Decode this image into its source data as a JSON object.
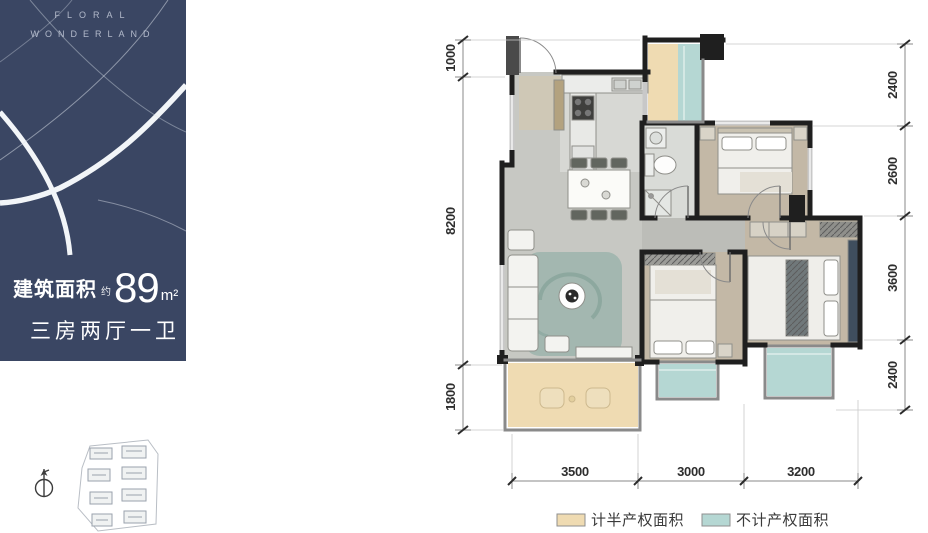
{
  "brand": {
    "line1": "FLORAL",
    "line2": "WONDERLAND"
  },
  "info": {
    "area_label": "建筑面积",
    "approx": "约",
    "area_value": "89",
    "area_unit": "m²",
    "layout": "三房两厅一卫"
  },
  "dims": {
    "left": [
      "1000",
      "8200",
      "1800"
    ],
    "right": [
      "2400",
      "2600",
      "3600",
      "2400"
    ],
    "bottom": [
      "3500",
      "3000",
      "3200"
    ]
  },
  "legend": [
    {
      "label": "计半产权面积",
      "color": "#efdbb2"
    },
    {
      "label": "不计产权面积",
      "color": "#b5d7d3"
    }
  ],
  "colors": {
    "sidebar_bg": "#3a4663",
    "wall": "#1f1f1f",
    "half_property": "#efdbb2",
    "non_property": "#b5d7d3",
    "floor_gray": "#c7c8c3",
    "floor_wood": "#c3b8a6",
    "rug": "#a3b7b0",
    "dim_text": "#2e2e2e"
  }
}
